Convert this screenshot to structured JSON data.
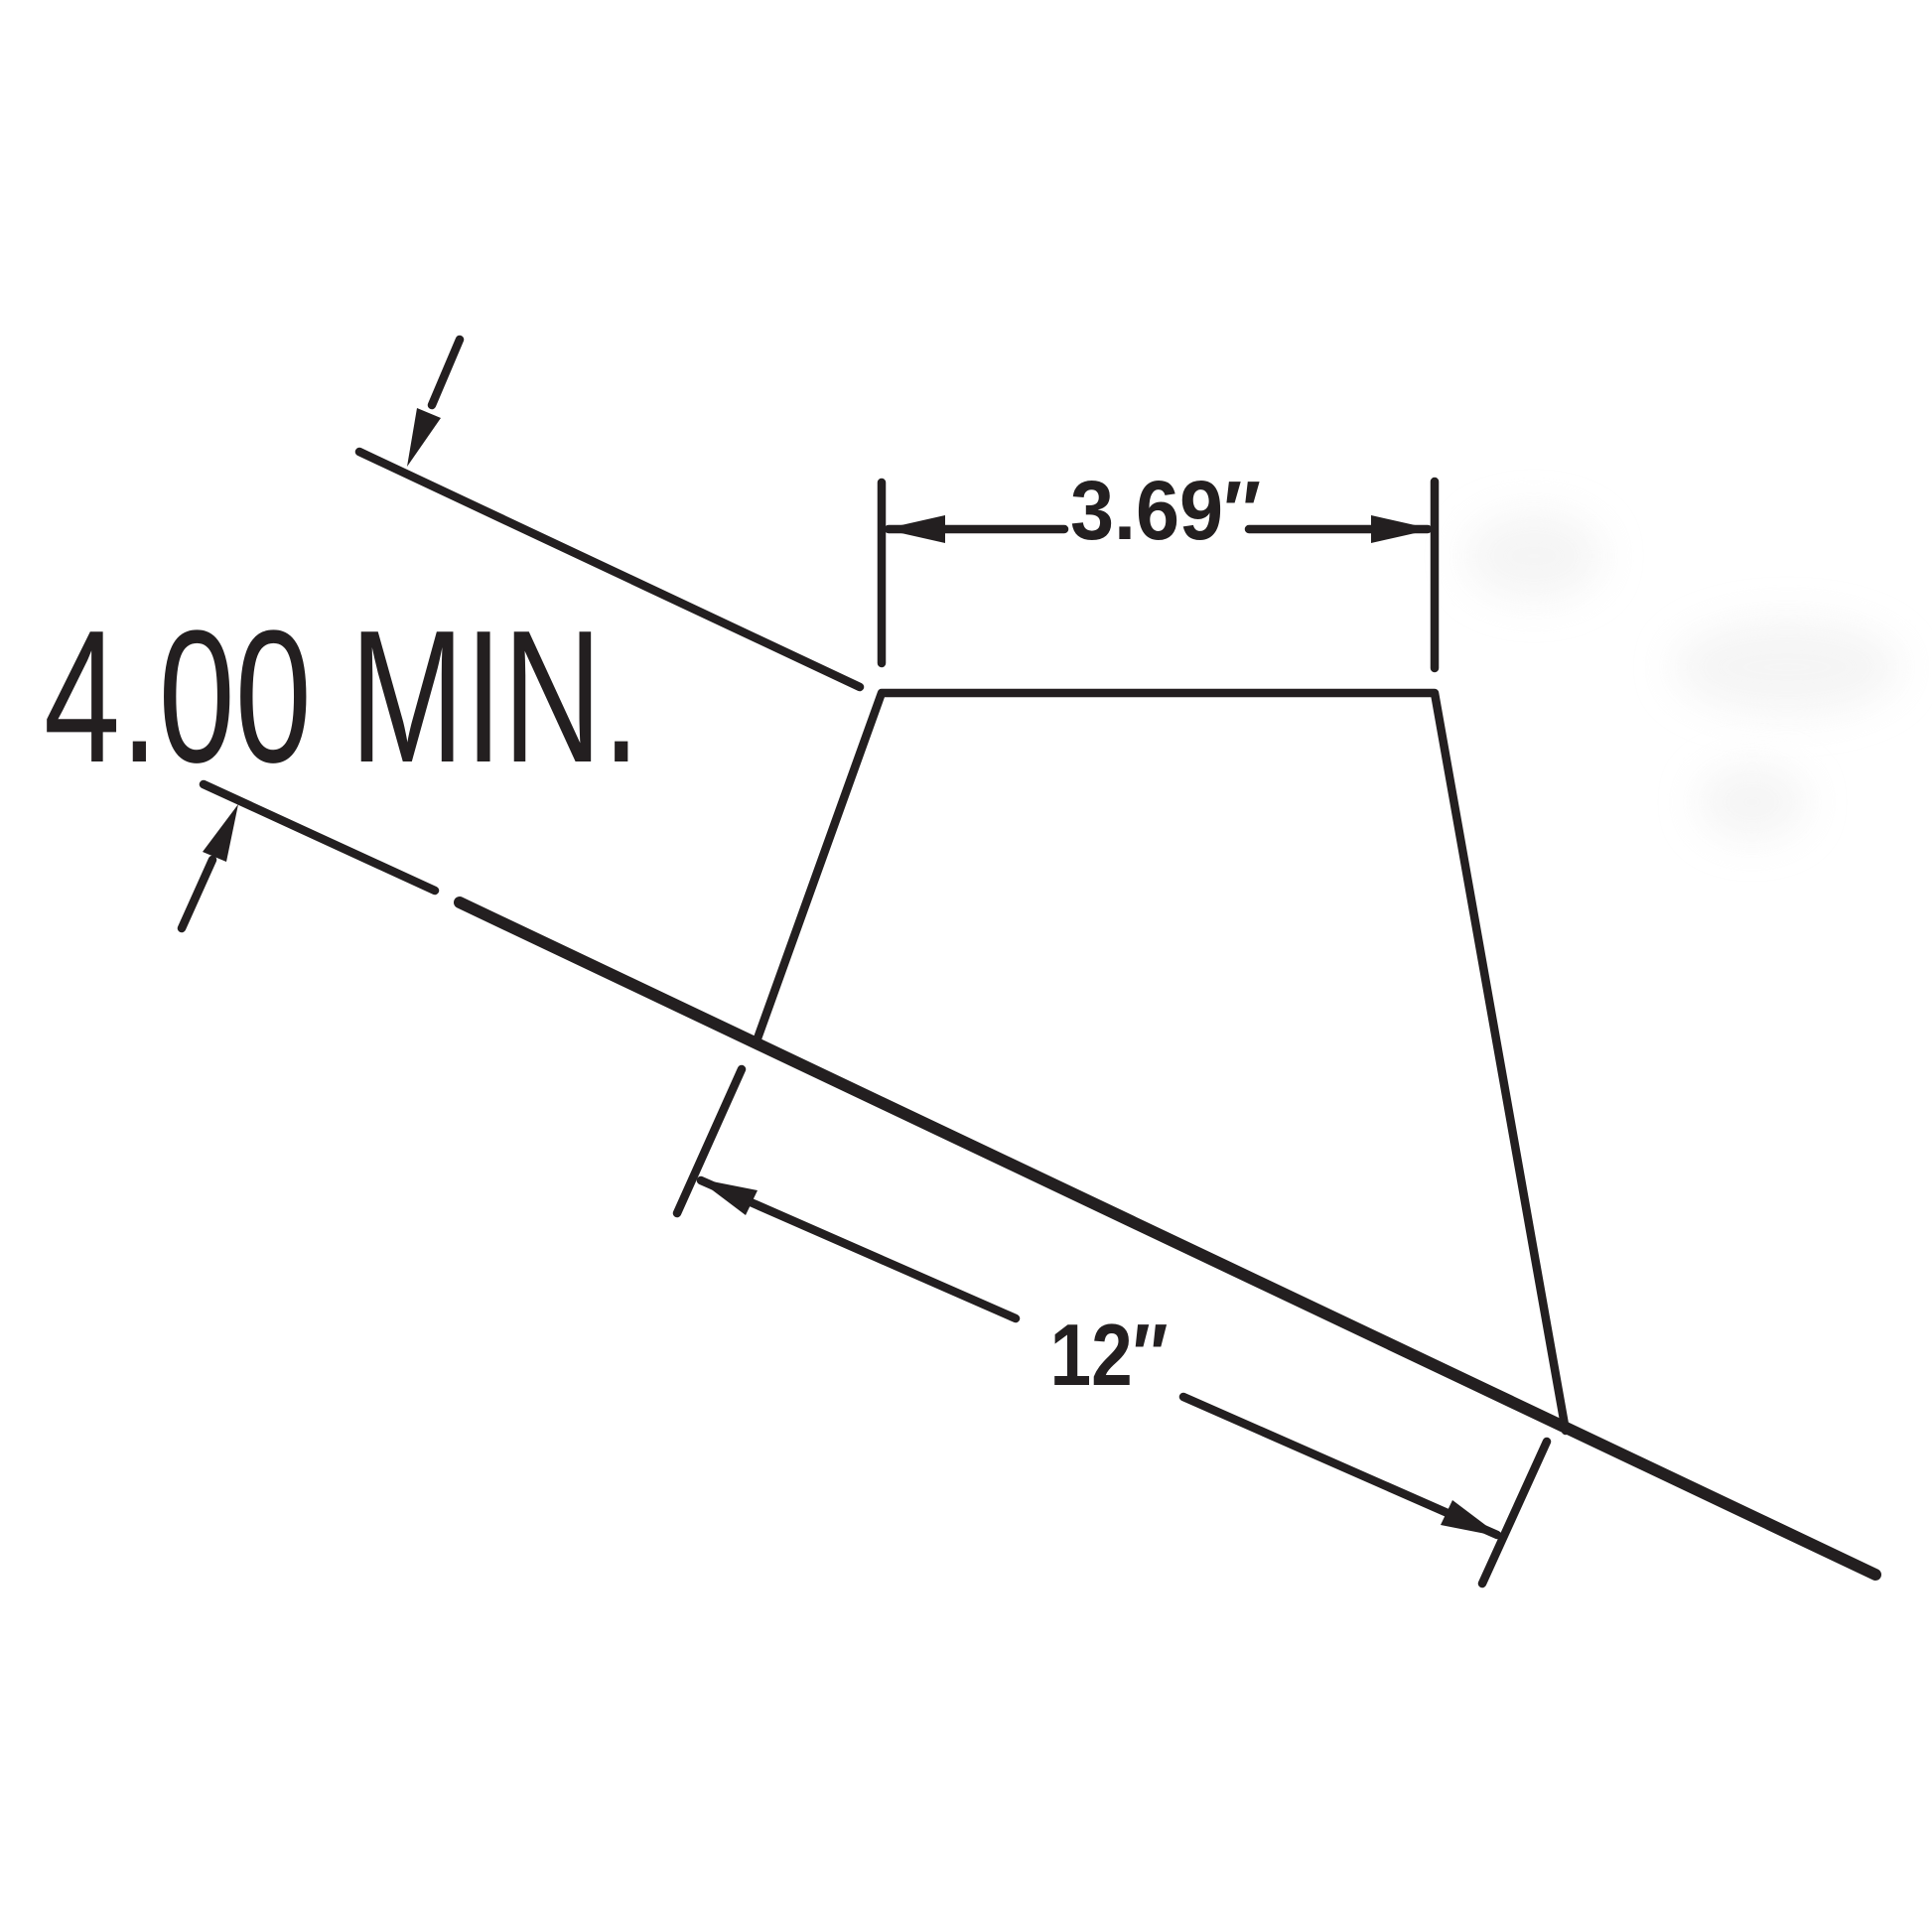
{
  "diagram": {
    "ink_color": "#231f20",
    "background_color": "#ffffff",
    "labels": {
      "min_clearance": "4.00 MIN.",
      "top_width": "3.69″",
      "bottom_length": "12″"
    }
  }
}
